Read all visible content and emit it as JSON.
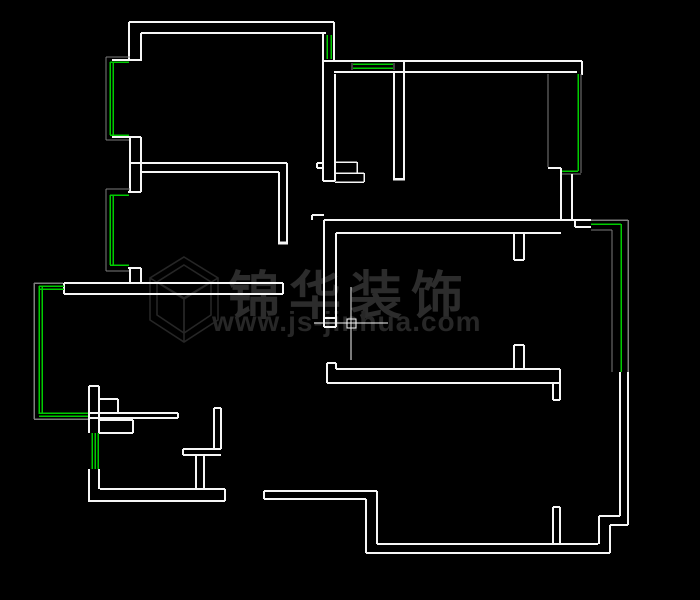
{
  "canvas": {
    "width": 700,
    "height": 600,
    "background": "#000000"
  },
  "palette": {
    "w": "#f6f6f6",
    "g": "#00cc00",
    "f": "#7d7d7d",
    "watermark_brand": "#2c2c2c",
    "watermark_url": "#272727",
    "watermark_logo": "#262626"
  },
  "watermark": {
    "brand": "锦华装饰",
    "url": "www.js-jinhua.com"
  },
  "icons": {
    "brand_logo": "cube-wireframe",
    "cursor": "cad-crosshair",
    "pickbox": "selection-pickbox"
  },
  "cursor": {
    "h": [
      314,
      323,
      388,
      323
    ],
    "v": [
      351,
      287,
      351,
      360
    ],
    "pickbox": [
      347,
      319,
      9,
      9
    ]
  },
  "floor_plan": {
    "legend": {
      "w": "wall-line",
      "g": "window-glass-line",
      "f": "window-frame-line"
    },
    "segments": [
      [
        129,
        22,
        334,
        22,
        "w",
        2
      ],
      [
        141,
        33,
        326,
        33,
        "w",
        2
      ],
      [
        129,
        22,
        129,
        61,
        "w",
        2
      ],
      [
        141,
        33,
        141,
        61,
        "w",
        2
      ],
      [
        334,
        22,
        334,
        61,
        "w",
        2
      ],
      [
        323,
        33,
        323,
        61,
        "w",
        2
      ],
      [
        327,
        35,
        327,
        59,
        "g",
        1.5
      ],
      [
        331,
        35,
        331,
        59,
        "g",
        1.5
      ],
      [
        112,
        60,
        141,
        60,
        "w",
        2
      ],
      [
        112,
        137,
        141,
        137,
        "w",
        2
      ],
      [
        106,
        57,
        106,
        140,
        "f",
        1.2
      ],
      [
        106,
        57,
        130,
        57,
        "f",
        1.2
      ],
      [
        106,
        140,
        130,
        140,
        "f",
        1.2
      ],
      [
        110,
        62,
        110,
        135,
        "g",
        1.5
      ],
      [
        113,
        62,
        113,
        135,
        "g",
        1.5
      ],
      [
        110,
        62,
        129,
        62,
        "g",
        1.5
      ],
      [
        110,
        135,
        129,
        135,
        "g",
        1.5
      ],
      [
        130,
        137,
        130,
        192,
        "w",
        2
      ],
      [
        141,
        137,
        141,
        192,
        "w",
        2
      ],
      [
        128,
        192,
        141,
        192,
        "w",
        2
      ],
      [
        128,
        268,
        141,
        268,
        "w",
        2
      ],
      [
        106,
        189,
        106,
        271,
        "f",
        1.2
      ],
      [
        106,
        189,
        130,
        189,
        "f",
        1.2
      ],
      [
        106,
        271,
        130,
        271,
        "f",
        1.2
      ],
      [
        110,
        195,
        110,
        265,
        "g",
        1.5
      ],
      [
        113,
        195,
        113,
        265,
        "g",
        1.5
      ],
      [
        110,
        195,
        129,
        195,
        "g",
        1.5
      ],
      [
        110,
        265,
        129,
        265,
        "g",
        1.5
      ],
      [
        130,
        268,
        130,
        283,
        "w",
        2
      ],
      [
        141,
        268,
        141,
        283,
        "w",
        2
      ],
      [
        130,
        163,
        287,
        163,
        "w",
        2
      ],
      [
        141,
        172,
        279,
        172,
        "w",
        2
      ],
      [
        287,
        163,
        287,
        242,
        "w",
        2
      ],
      [
        279,
        172,
        279,
        242,
        "w",
        2
      ],
      [
        278,
        243,
        288,
        243,
        "w",
        3
      ],
      [
        64,
        283,
        283,
        283,
        "w",
        2
      ],
      [
        64,
        294,
        283,
        294,
        "w",
        2
      ],
      [
        64,
        283,
        64,
        294,
        "w",
        2
      ],
      [
        283,
        283,
        283,
        294,
        "w",
        2
      ],
      [
        34,
        283,
        34,
        419,
        "f",
        1.5
      ],
      [
        34,
        283,
        63,
        283,
        "f",
        1.5
      ],
      [
        34,
        419,
        90,
        419,
        "f",
        1.5
      ],
      [
        39,
        286,
        39,
        414,
        "g",
        1.5
      ],
      [
        42,
        286,
        42,
        414,
        "g",
        1.5
      ],
      [
        39,
        286,
        64,
        286,
        "g",
        1.5
      ],
      [
        39,
        289,
        64,
        289,
        "g",
        1.5
      ],
      [
        39,
        413,
        89,
        413,
        "g",
        1.5
      ],
      [
        39,
        416,
        89,
        416,
        "g",
        1.5
      ],
      [
        89,
        386,
        89,
        433,
        "w",
        2
      ],
      [
        99,
        386,
        99,
        433,
        "w",
        2
      ],
      [
        89,
        386,
        99,
        386,
        "w",
        2
      ],
      [
        92,
        433,
        92,
        469,
        "g",
        1.5
      ],
      [
        95,
        433,
        95,
        469,
        "g",
        1.5
      ],
      [
        98,
        433,
        98,
        469,
        "g",
        1.5
      ],
      [
        89,
        469,
        89,
        502,
        "w",
        2
      ],
      [
        99,
        469,
        99,
        489,
        "w",
        2
      ],
      [
        99,
        399,
        118,
        399,
        "w",
        2
      ],
      [
        118,
        399,
        118,
        413,
        "w",
        2
      ],
      [
        89,
        413,
        178,
        413,
        "w",
        2
      ],
      [
        89,
        418,
        178,
        418,
        "w",
        2
      ],
      [
        178,
        413,
        178,
        418,
        "w",
        2
      ],
      [
        99,
        420,
        133,
        420,
        "w",
        2
      ],
      [
        133,
        420,
        133,
        433,
        "w",
        2
      ],
      [
        99,
        433,
        133,
        433,
        "w",
        2
      ],
      [
        214,
        408,
        214,
        449,
        "w",
        2
      ],
      [
        221,
        408,
        221,
        449,
        "w",
        2
      ],
      [
        214,
        408,
        221,
        408,
        "w",
        2
      ],
      [
        183,
        449,
        221,
        449,
        "w",
        2
      ],
      [
        183,
        455,
        221,
        455,
        "w",
        2
      ],
      [
        183,
        449,
        183,
        455,
        "w",
        2
      ],
      [
        196,
        455,
        196,
        489,
        "w",
        2
      ],
      [
        204,
        455,
        204,
        489,
        "w",
        2
      ],
      [
        100,
        489,
        225,
        489,
        "w",
        2
      ],
      [
        89,
        501,
        225,
        501,
        "w",
        2
      ],
      [
        225,
        489,
        225,
        501,
        "w",
        2
      ],
      [
        322,
        61,
        582,
        61,
        "w",
        2
      ],
      [
        334,
        72,
        577,
        72,
        "w",
        2
      ],
      [
        582,
        61,
        582,
        75,
        "w",
        2
      ],
      [
        353,
        64,
        393,
        64,
        "g",
        1.5
      ],
      [
        353,
        68,
        393,
        68,
        "g",
        1.5
      ],
      [
        352,
        63,
        352,
        70,
        "f",
        1.2
      ],
      [
        394,
        63,
        394,
        70,
        "f",
        1.2
      ],
      [
        323,
        61,
        323,
        181,
        "w",
        2
      ],
      [
        335,
        74,
        335,
        181,
        "w",
        2
      ],
      [
        323,
        181,
        335,
        181,
        "w",
        2
      ],
      [
        317,
        163,
        323,
        163,
        "w",
        2
      ],
      [
        317,
        168,
        323,
        168,
        "w",
        2
      ],
      [
        317,
        163,
        317,
        168,
        "w",
        2
      ],
      [
        335,
        162,
        357,
        162,
        "w",
        1.5
      ],
      [
        357,
        162,
        357,
        173,
        "w",
        1.5
      ],
      [
        335,
        173,
        364,
        173,
        "w",
        1.5
      ],
      [
        364,
        173,
        364,
        182,
        "w",
        1.5
      ],
      [
        335,
        182,
        364,
        182,
        "w",
        1.5
      ],
      [
        394,
        72,
        394,
        178,
        "w",
        2
      ],
      [
        404,
        62,
        404,
        178,
        "w",
        2
      ],
      [
        393,
        179,
        405,
        179,
        "w",
        2.5
      ],
      [
        548,
        74,
        548,
        167,
        "f",
        1.2
      ],
      [
        548,
        168,
        561,
        168,
        "w",
        2
      ],
      [
        578,
        74,
        578,
        171,
        "g",
        1.5
      ],
      [
        581,
        74,
        581,
        173,
        "f",
        1.2
      ],
      [
        561,
        171,
        578,
        171,
        "g",
        1.5
      ],
      [
        561,
        174,
        581,
        174,
        "f",
        1.2
      ],
      [
        561,
        168,
        561,
        220,
        "w",
        2
      ],
      [
        572,
        174,
        572,
        220,
        "w",
        2
      ],
      [
        312,
        215,
        324,
        215,
        "w",
        2
      ],
      [
        312,
        215,
        312,
        220,
        "w",
        2
      ],
      [
        324,
        220,
        591,
        220,
        "w",
        2
      ],
      [
        336,
        233,
        561,
        233,
        "w",
        2
      ],
      [
        575,
        227,
        591,
        227,
        "w",
        2
      ],
      [
        575,
        220,
        575,
        227,
        "w",
        2
      ],
      [
        324,
        220,
        324,
        327,
        "w",
        2
      ],
      [
        336,
        233,
        336,
        327,
        "w",
        2
      ],
      [
        324,
        318,
        336,
        318,
        "w",
        2
      ],
      [
        324,
        327,
        336,
        327,
        "w",
        2
      ],
      [
        514,
        233,
        514,
        260,
        "w",
        2
      ],
      [
        524,
        233,
        524,
        260,
        "w",
        2
      ],
      [
        514,
        260,
        524,
        260,
        "w",
        2
      ],
      [
        327,
        363,
        327,
        383,
        "w",
        2
      ],
      [
        327,
        363,
        336,
        363,
        "w",
        2
      ],
      [
        336,
        363,
        336,
        369,
        "w",
        2
      ],
      [
        336,
        369,
        560,
        369,
        "w",
        2
      ],
      [
        327,
        383,
        560,
        383,
        "w",
        2
      ],
      [
        560,
        369,
        560,
        383,
        "w",
        2
      ],
      [
        514,
        345,
        514,
        369,
        "w",
        2
      ],
      [
        524,
        345,
        524,
        369,
        "w",
        2
      ],
      [
        514,
        345,
        524,
        345,
        "w",
        2
      ],
      [
        553,
        383,
        553,
        400,
        "w",
        2
      ],
      [
        560,
        383,
        560,
        400,
        "w",
        2
      ],
      [
        553,
        400,
        560,
        400,
        "w",
        2
      ],
      [
        591,
        220,
        628,
        220,
        "f",
        1.5
      ],
      [
        628,
        220,
        628,
        372,
        "f",
        1.5
      ],
      [
        591,
        224,
        621,
        224,
        "g",
        1.5
      ],
      [
        621,
        224,
        621,
        372,
        "g",
        1.5
      ],
      [
        591,
        230,
        612,
        230,
        "f",
        1.2
      ],
      [
        612,
        230,
        612,
        372,
        "f",
        1.2
      ],
      [
        620,
        372,
        620,
        516,
        "w",
        2
      ],
      [
        628,
        372,
        628,
        525,
        "w",
        2
      ],
      [
        599,
        516,
        620,
        516,
        "w",
        2
      ],
      [
        610,
        525,
        628,
        525,
        "w",
        2
      ],
      [
        599,
        516,
        599,
        544,
        "w",
        2
      ],
      [
        610,
        525,
        610,
        553,
        "w",
        2
      ],
      [
        377,
        544,
        598,
        544,
        "w",
        2
      ],
      [
        366,
        553,
        610,
        553,
        "w",
        2
      ],
      [
        264,
        491,
        377,
        491,
        "w",
        2
      ],
      [
        264,
        499,
        366,
        499,
        "w",
        2
      ],
      [
        264,
        491,
        264,
        499,
        "w",
        2
      ],
      [
        377,
        491,
        377,
        544,
        "w",
        2
      ],
      [
        366,
        499,
        366,
        553,
        "w",
        2
      ],
      [
        553,
        507,
        553,
        544,
        "w",
        2
      ],
      [
        560,
        507,
        560,
        544,
        "w",
        2
      ],
      [
        553,
        507,
        560,
        507,
        "w",
        2
      ]
    ]
  }
}
